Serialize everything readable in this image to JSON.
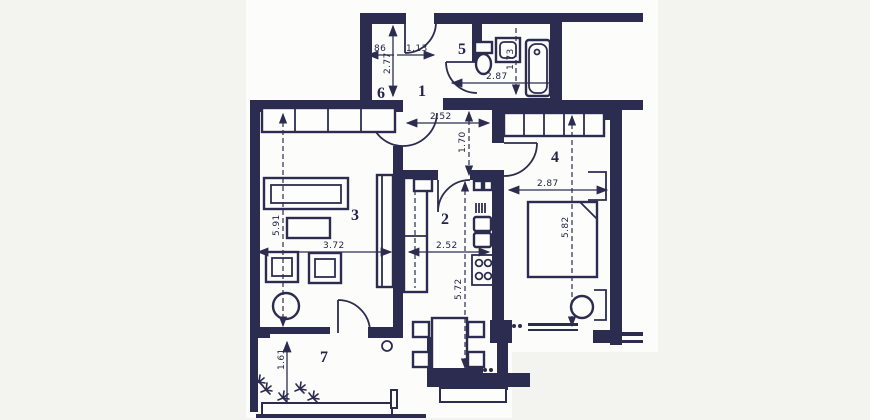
{
  "plan": {
    "type": "apartment-floor-plan",
    "colors": {
      "ink": "#2c2c50",
      "paper": "#fcfcfa",
      "background": "#f3f3f0"
    },
    "rooms": [
      {
        "label": "1"
      },
      {
        "label": "2"
      },
      {
        "label": "3"
      },
      {
        "label": "4"
      },
      {
        "label": "5"
      },
      {
        "label": "6"
      },
      {
        "label": "7"
      }
    ],
    "dimensions": [
      {
        "value": "86"
      },
      {
        "value": "1.13"
      },
      {
        "value": "2.77"
      },
      {
        "value": "2.87"
      },
      {
        "value": "1.73"
      },
      {
        "value": "2.52"
      },
      {
        "value": "1.70"
      },
      {
        "value": "2.87"
      },
      {
        "value": "5.82"
      },
      {
        "value": "5.91"
      },
      {
        "value": "3.72"
      },
      {
        "value": "2.52"
      },
      {
        "value": "5.72"
      },
      {
        "value": "1.61"
      }
    ]
  }
}
